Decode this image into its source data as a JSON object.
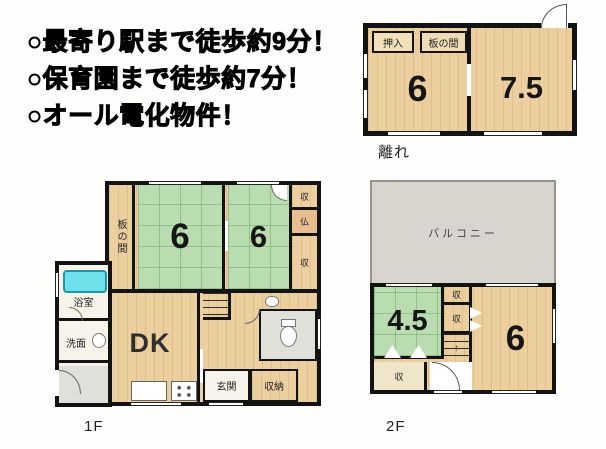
{
  "notes": {
    "lines": [
      "○最寄り駅まで徒歩約9分！",
      "○保育園まで徒歩約7分！",
      "○オール電化物件！"
    ]
  },
  "hanare": {
    "caption": "離れ",
    "oshiire": "押入",
    "itanoma": "板の間",
    "room_left": "6",
    "room_right": "7.5"
  },
  "floor1": {
    "caption": "1F",
    "itanoma": "板の間",
    "tatami_a": "6",
    "tatami_b": "6",
    "closet_top": "収",
    "butsudan": "仏",
    "closet_right": "収",
    "bathroom": "浴室",
    "washroom": "洗面",
    "dk": "DK",
    "entrance": "玄関",
    "storage": "収納"
  },
  "floor2": {
    "caption": "2F",
    "balcony": "バルコニー",
    "tatami": "4.5",
    "closet_a": "収",
    "closet_b": "収",
    "closet_c": "収",
    "room": "6",
    "stairs_arrow": "↑"
  },
  "colors": {
    "wall": "#131313",
    "wood_floor": "#ebcf9f",
    "tatami_green": "#b9ddb0",
    "balcony_gray": "#d7d5ce",
    "utility_gray": "#dfe0d9",
    "bathtub_cyan": "#70e0ea",
    "butsudan_tan": "#e8bd90"
  }
}
